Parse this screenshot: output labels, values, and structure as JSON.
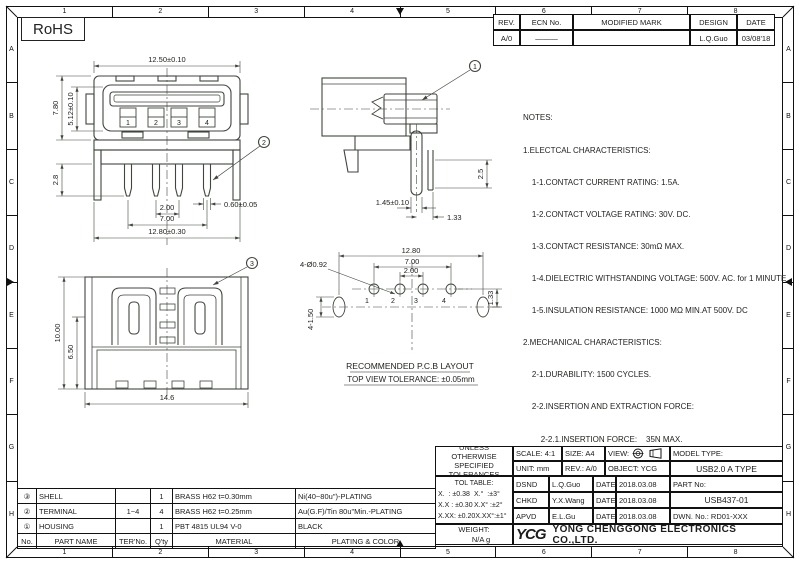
{
  "colors": {
    "drawing_line": "#3f463c",
    "table_line": "#111111",
    "ink": "#1c1c1c"
  },
  "rohs": {
    "label": "RoHS"
  },
  "grid": {
    "cols": [
      "1",
      "2",
      "3",
      "4",
      "5",
      "6",
      "7",
      "8"
    ],
    "rows": [
      "A",
      "B",
      "C",
      "D",
      "E",
      "F",
      "G",
      "H"
    ]
  },
  "revision_table": {
    "headers": {
      "rev": "REV.",
      "ecn": "ECN No.",
      "modified": "MODIFIED MARK",
      "design": "DESIGN",
      "date": "DATE"
    },
    "row": {
      "rev": "A/0",
      "ecn": "———",
      "modified": "",
      "design": "L.Q.Guo",
      "date": "03/08'18"
    }
  },
  "notes": {
    "lines": [
      "NOTES:",
      "1.ELECTCAL CHARACTERISTICS:",
      "    1-1.CONTACT CURRENT RATING: 1.5A.",
      "    1-2.CONTACT VOLTAGE RATING: 30V. DC.",
      "    1-3.CONTACT RESISTANCE: 30mΩ MAX.",
      "    1-4.DIELECTRIC WITHSTANDING VOLTAGE: 500V. AC. for 1 MINUTE",
      "    1-5.INSULATION RESISTANCE: 1000 MΩ MIN.AT 500V. DC",
      "2.MECHANICAL CHARACTERISTICS:",
      "    2-1.DURABILITY: 1500 CYCLES.",
      "    2-2.INSERTION AND EXTRACTION FORCE:",
      "        2-2.1.INSERTION FORCE:    35N MAX.",
      "        2-2.2.EXTRACTION FORCE: 10N MIN.",
      "3.ENVIRENMENT CHARACTERISTICS:",
      "    3-1.OPERATING TEMPERATURE.-20℃~+65℃"
    ]
  },
  "views": {
    "front": {
      "dims": {
        "width_top": "12.50±0.10",
        "height_outer": "7.80",
        "height_inner": "5.12±0.10",
        "pin_length": "2.8",
        "pin_pitch": "2.00",
        "pin_span": "7.00",
        "width_bottom": "12.80±0.30",
        "pin_width": "0.60±0.05"
      },
      "pins": [
        "1",
        "2",
        "3",
        "4"
      ],
      "callout": "2"
    },
    "side": {
      "dims": {
        "slot_width": "1.45±0.10",
        "pin_offset": "1.33",
        "pin_protrusion": "2.5"
      },
      "callout": "1"
    },
    "top": {
      "dims": {
        "height": "10.00",
        "inner_height": "6.50",
        "width": "14.6"
      },
      "callout": "3"
    },
    "pcb": {
      "dims": {
        "span": "12.80",
        "pin_span": "7.00",
        "pin_pitch": "2.00",
        "hole_dia": "4-Ø0.92",
        "slot_size": "4-1.50",
        "row_offset": "1.33"
      },
      "holes": [
        "1",
        "2",
        "3",
        "4"
      ],
      "title": "RECOMMENDED P.C.B LAYOUT",
      "subtitle": "TOP VIEW TOLERANCE: ±0.05mm"
    }
  },
  "title_block": {
    "tol_header_line1": "UNLESS OTHERWISE",
    "tol_header_line2": "SPECIFIED TOLERANCES",
    "tol_table_title": "TOL TABLE:",
    "tol_rows": [
      {
        "lin": "X.  : ±0.38",
        "ang": "X.°  :±3°"
      },
      {
        "lin": "X.X : ±0.30",
        "ang": "X.X° :±2°"
      },
      {
        "lin": "X.XX: ±0.20",
        "ang": "X.XX°:±1°"
      }
    ],
    "scale": "SCALE: 4:1",
    "size": "SIZE: A4",
    "view_label": "VIEW:",
    "unit": "UNIT: mm",
    "rev": "REV.: A/0",
    "object": "OBJECT: YCG",
    "model_type_label": "MODEL TYPE:",
    "model_type_value": "USB2.0 A TYPE",
    "part_no_label": "PART No:",
    "part_no_value": "USB437-01",
    "dwn_no": "DWN. No.: RD01-XXX",
    "sign_rows": [
      {
        "role": "DSND",
        "name": "L.Q.Guo",
        "date_label": "DATE",
        "date": "2018.03.08"
      },
      {
        "role": "CHKD",
        "name": "Y.X.Wang",
        "date_label": "DATE",
        "date": "2018.03.08"
      },
      {
        "role": "APVD",
        "name": "E.L.Gu",
        "date_label": "DATE",
        "date": "2018.03.08"
      }
    ],
    "weight_label": "WEIGHT:",
    "weight_value": "N/A g",
    "logo_text": "YCG",
    "company": "YONG CHENGGONG ELECTRONICS CO.,LTD."
  },
  "parts_table": {
    "headers": {
      "no": "No.",
      "name": "PART NAME",
      "ter": "TER'No.",
      "qty": "Q'ty",
      "material": "MATERIAL",
      "plating": "PLATING & COLOR"
    },
    "rows": [
      {
        "no": "③",
        "name": "SHELL",
        "ter": "",
        "qty": "1",
        "material": "BRASS H62 t=0.30mm",
        "plating": "Ni(40~80u\")-PLATING"
      },
      {
        "no": "②",
        "name": "TERMINAL",
        "ter": "1~4",
        "qty": "4",
        "material": "BRASS H62 t=0.25mm",
        "plating": "Au(G.F)/Tin 80u\"Min.-PLATING"
      },
      {
        "no": "①",
        "name": "HOUSING",
        "ter": "",
        "qty": "1",
        "material": "PBT 4815 UL94 V-0",
        "plating": "BLACK"
      }
    ]
  }
}
